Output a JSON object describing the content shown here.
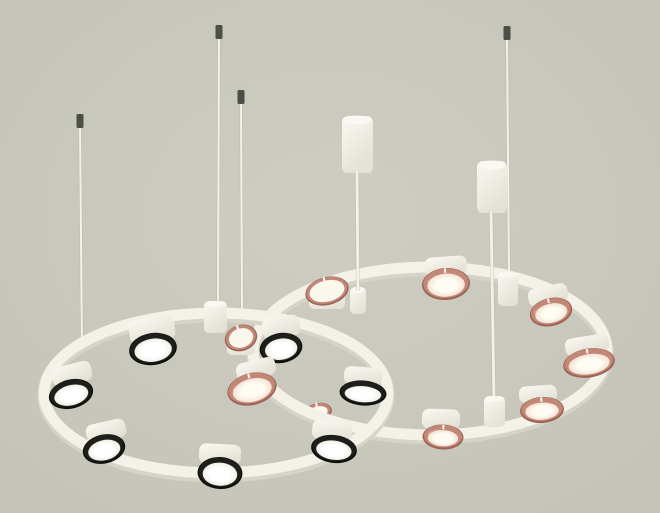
{
  "image": {
    "width": 660,
    "height": 513,
    "description": "Product photo of a modern two-ring chandelier: white ring frames suspended by thin cables and two cylindrical ceiling canopies; left ring carries 7 white drum shades with black trim rings and glowing white diffusers; right ring carries 9 drum shades with polished copper trim rings; pale warm-grey studio background.",
    "shade_counts": {
      "black_trim": 7,
      "copper_trim": 9
    }
  },
  "scene": {
    "palette": {
      "bg_center": "#cecdc1",
      "bg_edge": "#c4c3b7",
      "white_hi": "#faf8f2",
      "white_lo": "#e4e1d6",
      "band": "#f3f1e8",
      "band_shadow": "#d6d3c7",
      "wire_light": "#f3f1e9",
      "wire_dark": "#b5b4a8",
      "cap_gray": "#4e4e49",
      "black_rim_dark": "#0f0f0c",
      "black_rim_base": "#1e1e1a",
      "copper_dark": "#9c6254",
      "copper_base": "#c28877",
      "copper_light": "#d8a893",
      "open_face": "#faf7ed",
      "face_black_center": "#ffffff",
      "face_black_edge": "#f0eee5",
      "face_copper_center": "#fffdf3",
      "face_copper_edge": "#f3e2d5"
    },
    "wires": [
      {
        "x1": 80,
        "y1": 127,
        "x2": 82,
        "y2": 349,
        "cap": {
          "x": 76.5,
          "y": 114,
          "w": 7,
          "h": 14
        }
      },
      {
        "x1": 219,
        "y1": 38,
        "x2": 218,
        "y2": 304,
        "cap": {
          "x": 215.5,
          "y": 25,
          "w": 7,
          "h": 14
        }
      },
      {
        "x1": 241,
        "y1": 103,
        "x2": 242,
        "y2": 310,
        "cap": {
          "x": 237.5,
          "y": 90,
          "w": 7,
          "h": 14
        }
      },
      {
        "x1": 507,
        "y1": 39,
        "x2": 509,
        "y2": 276,
        "cap": {
          "x": 503.5,
          "y": 26,
          "w": 7,
          "h": 14
        }
      }
    ],
    "canopies": [
      {
        "x": 342,
        "y": 116,
        "w": 31,
        "h": 57
      },
      {
        "x": 477,
        "y": 161,
        "w": 30,
        "h": 52
      }
    ],
    "cords": [
      {
        "x1": 357,
        "y1": 170,
        "x2": 358,
        "y2": 291
      },
      {
        "x1": 491,
        "y1": 211,
        "x2": 494,
        "y2": 400
      }
    ],
    "rings": [
      {
        "id": "right-ring",
        "cx": 430,
        "cy": 351,
        "rx": 177,
        "ry": 84
      },
      {
        "id": "left-ring",
        "cx": 216,
        "cy": 393,
        "rx": 172,
        "ry": 80
      }
    ],
    "joints_back": [
      {
        "id": "left-ring-hub",
        "x": 204,
        "y": 301,
        "w": 23,
        "h": 32
      },
      {
        "id": "right-ring-top-joint",
        "x": 498,
        "y": 272,
        "w": 20,
        "h": 34
      },
      {
        "id": "cord-joint",
        "x": 350,
        "y": 287,
        "w": 16,
        "h": 27
      }
    ],
    "joints_front": [
      {
        "id": "right-ring-bottom-joint",
        "x": 484,
        "y": 396,
        "w": 21,
        "h": 31
      }
    ],
    "open_shades_behind": [
      {
        "cx": 318,
        "cy": 412,
        "rx": 14,
        "ry": 9,
        "rot": -12,
        "body": null
      }
    ],
    "open_shades": [
      {
        "cx": 241,
        "cy": 338,
        "rx": 16.5,
        "ry": 13,
        "rot": -18,
        "body": {
          "w": 28,
          "h": 16
        }
      },
      {
        "cx": 327,
        "cy": 291,
        "rx": 22,
        "ry": 14,
        "rot": -14,
        "body": {
          "w": 36,
          "h": 17
        }
      }
    ],
    "front_shades": [
      {
        "ring": "left",
        "rim": "black",
        "cx": 153,
        "cy": 349,
        "rx": 24,
        "ry": 16,
        "rot": -8,
        "body": {
          "cx": 152,
          "cy": 330,
          "w": 46,
          "h": 23
        }
      },
      {
        "ring": "left",
        "rim": "black",
        "cx": 281,
        "cy": 348,
        "rx": 21.5,
        "ry": 15,
        "rot": -9,
        "body": {
          "cx": 281,
          "cy": 327,
          "w": 38,
          "h": 21
        }
      },
      {
        "ring": "right",
        "rim": "copper",
        "cx": 446,
        "cy": 284,
        "rx": 24,
        "ry": 16,
        "rot": -4,
        "body": {
          "cx": 446,
          "cy": 266,
          "w": 42,
          "h": 19
        }
      },
      {
        "ring": "right",
        "rim": "copper",
        "cx": 551,
        "cy": 312,
        "rx": 21.5,
        "ry": 14,
        "rot": -13,
        "body": {
          "cx": 548,
          "cy": 295,
          "w": 40,
          "h": 18
        }
      },
      {
        "ring": "left",
        "rim": "black",
        "cx": 71,
        "cy": 394,
        "rx": 22.5,
        "ry": 14.5,
        "rot": -14,
        "body": {
          "cx": 72,
          "cy": 374,
          "w": 40,
          "h": 20
        }
      },
      {
        "ring": "right",
        "rim": "copper",
        "cx": 252,
        "cy": 389,
        "rx": 25,
        "ry": 16,
        "rot": -14,
        "body": {
          "cx": 256,
          "cy": 369,
          "w": 40,
          "h": 18
        }
      },
      {
        "ring": "left",
        "rim": "black",
        "cx": 363,
        "cy": 393,
        "rx": 23.5,
        "ry": 12.5,
        "rot": 4,
        "body": {
          "cx": 363,
          "cy": 376,
          "w": 38,
          "h": 18
        }
      },
      {
        "ring": "right",
        "rim": "copper",
        "cx": 589,
        "cy": 363,
        "rx": 26,
        "ry": 14.5,
        "rot": -9,
        "body": {
          "cx": 587,
          "cy": 345,
          "w": 44,
          "h": 18
        }
      },
      {
        "ring": "left",
        "rim": "black",
        "cx": 104,
        "cy": 449,
        "rx": 21.5,
        "ry": 14.5,
        "rot": -13,
        "body": {
          "cx": 106,
          "cy": 431,
          "w": 40,
          "h": 19
        }
      },
      {
        "ring": "right",
        "rim": "copper",
        "cx": 542,
        "cy": 410,
        "rx": 22,
        "ry": 13,
        "rot": -4,
        "body": {
          "cx": 538,
          "cy": 394,
          "w": 38,
          "h": 17
        }
      },
      {
        "ring": "left",
        "rim": "black",
        "cx": 220,
        "cy": 473,
        "rx": 22.5,
        "ry": 16,
        "rot": 3,
        "body": {
          "cx": 220,
          "cy": 454,
          "w": 42,
          "h": 20
        }
      },
      {
        "ring": "left",
        "rim": "black",
        "cx": 334,
        "cy": 449,
        "rx": 23,
        "ry": 14,
        "rot": 7,
        "body": {
          "cx": 332,
          "cy": 431,
          "w": 40,
          "h": 19
        }
      },
      {
        "ring": "right",
        "rim": "copper",
        "cx": 443,
        "cy": 437,
        "rx": 20.5,
        "ry": 12.5,
        "rot": 2,
        "body": {
          "cx": 441,
          "cy": 419,
          "w": 38,
          "h": 20
        }
      }
    ]
  }
}
